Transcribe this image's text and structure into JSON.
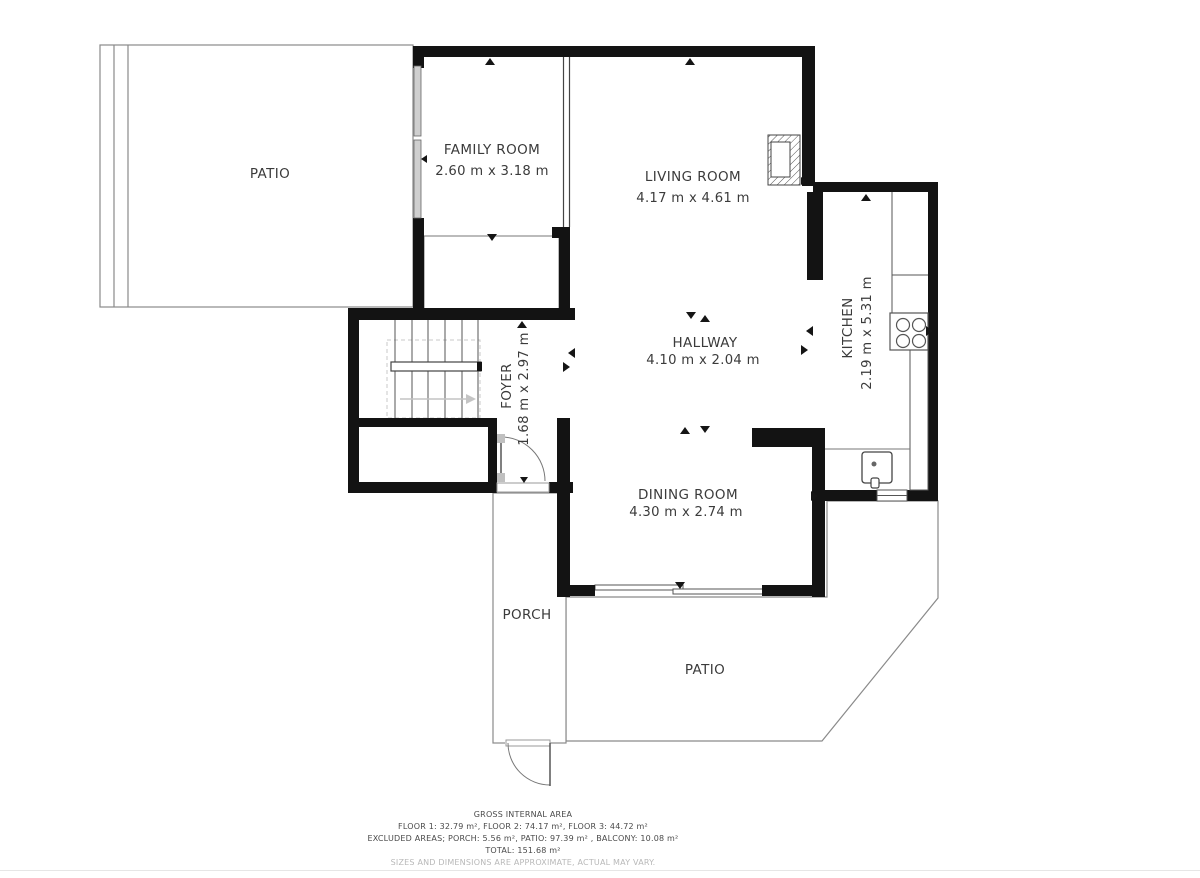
{
  "rooms": {
    "patio_top": {
      "label": "PATIO"
    },
    "family_room": {
      "label": "FAMILY ROOM",
      "dimensions": "2.60 m x 3.18 m"
    },
    "living_room": {
      "label": "LIVING ROOM",
      "dimensions": "4.17 m x 4.61 m"
    },
    "hallway": {
      "label": "HALLWAY",
      "dimensions": "4.10 m x 2.04 m"
    },
    "kitchen": {
      "label": "KITCHEN",
      "dimensions": "2.19 m x 5.31 m"
    },
    "foyer": {
      "label": "FOYER",
      "dimensions": "1.68 m x 2.97 m"
    },
    "dining_room": {
      "label": "DINING ROOM",
      "dimensions": "4.30 m x 2.74 m"
    },
    "porch": {
      "label": "PORCH"
    },
    "patio_bottom": {
      "label": "PATIO"
    }
  },
  "footer": {
    "gross_internal_area": "GROSS INTERNAL AREA",
    "floors": "FLOOR 1: 32.79 m², FLOOR 2: 74.17 m², FLOOR 3: 44.72 m²",
    "excluded": "EXCLUDED AREAS; PORCH: 5.56 m², PATIO: 97.39 m² , BALCONY: 10.08 m²",
    "total": "TOTAL: 151.68 m²",
    "disclaimer": "SIZES AND DIMENSIONS ARE APPROXIMATE, ACTUAL MAY VARY."
  },
  "colors": {
    "wall": "#131313",
    "thin_line": "#8a8a8a",
    "window_fill": "#cfcfcf",
    "text": "#3b3b3b",
    "muted_text": "#b8b8b8"
  }
}
